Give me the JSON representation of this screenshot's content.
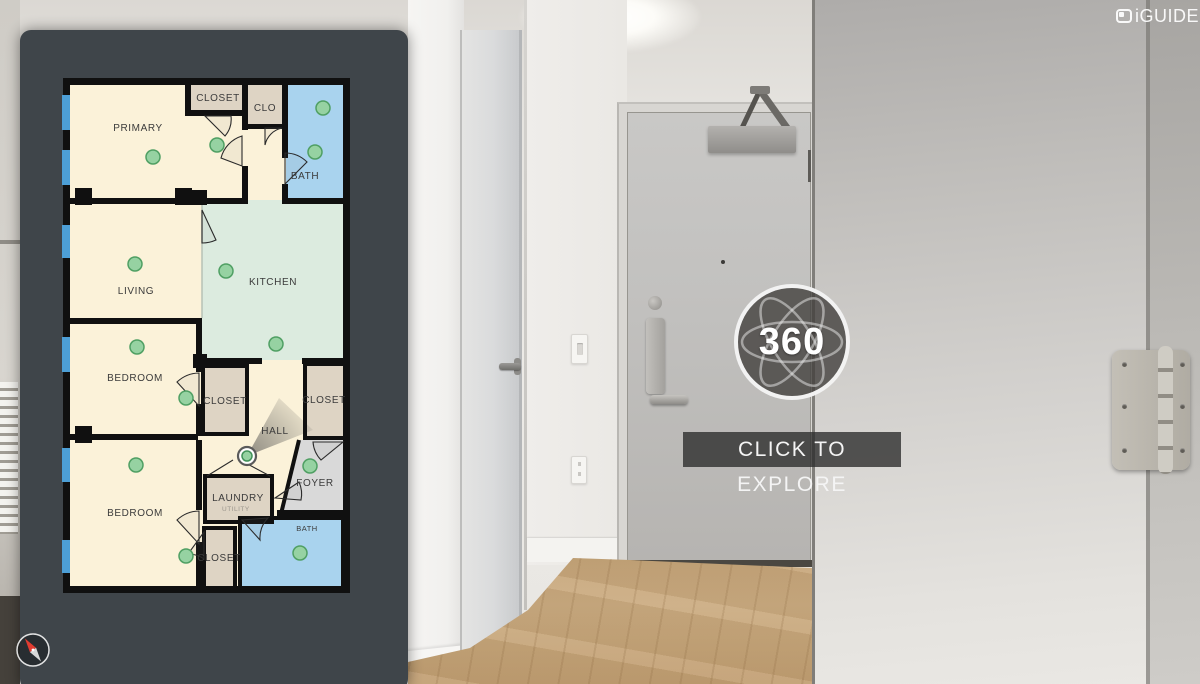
{
  "app": {
    "brand": "iGUIDE"
  },
  "overlay": {
    "badge_label": "360",
    "cta": "CLICK TO EXPLORE"
  },
  "floorplan": {
    "rooms": [
      {
        "id": "primary",
        "label": "PRIMARY"
      },
      {
        "id": "closet-primary",
        "label": "CLOSET"
      },
      {
        "id": "clo",
        "label": "CLO"
      },
      {
        "id": "bath-upper",
        "label": "BATH"
      },
      {
        "id": "living",
        "label": "LIVING"
      },
      {
        "id": "kitchen",
        "label": "KITCHEN"
      },
      {
        "id": "bedroom-1",
        "label": "BEDROOM"
      },
      {
        "id": "closet-mid-left",
        "label": "CLOSET"
      },
      {
        "id": "hall",
        "label": "HALL"
      },
      {
        "id": "closet-mid-right",
        "label": "CLOSET"
      },
      {
        "id": "foyer",
        "label": "FOYER"
      },
      {
        "id": "laundry",
        "label": "LAUNDRY",
        "sublabel": "UTILITY"
      },
      {
        "id": "bedroom-2",
        "label": "BEDROOM"
      },
      {
        "id": "closet-lower",
        "label": "CLOSET"
      },
      {
        "id": "bath-lower",
        "label": "BATH"
      }
    ],
    "colors": {
      "panel_bg": "#3f454a",
      "room_cream": "#fbf2d9",
      "room_mint": "#dcebdf",
      "room_blue": "#a9d3ee",
      "room_tan": "#ded4c4",
      "room_gray": "#d9d9d9",
      "wall": "#101010",
      "window_blue": "#4d9fd6",
      "waypoint_green": "#96d2a2",
      "waypoint_ring": "#4f9f63"
    }
  }
}
